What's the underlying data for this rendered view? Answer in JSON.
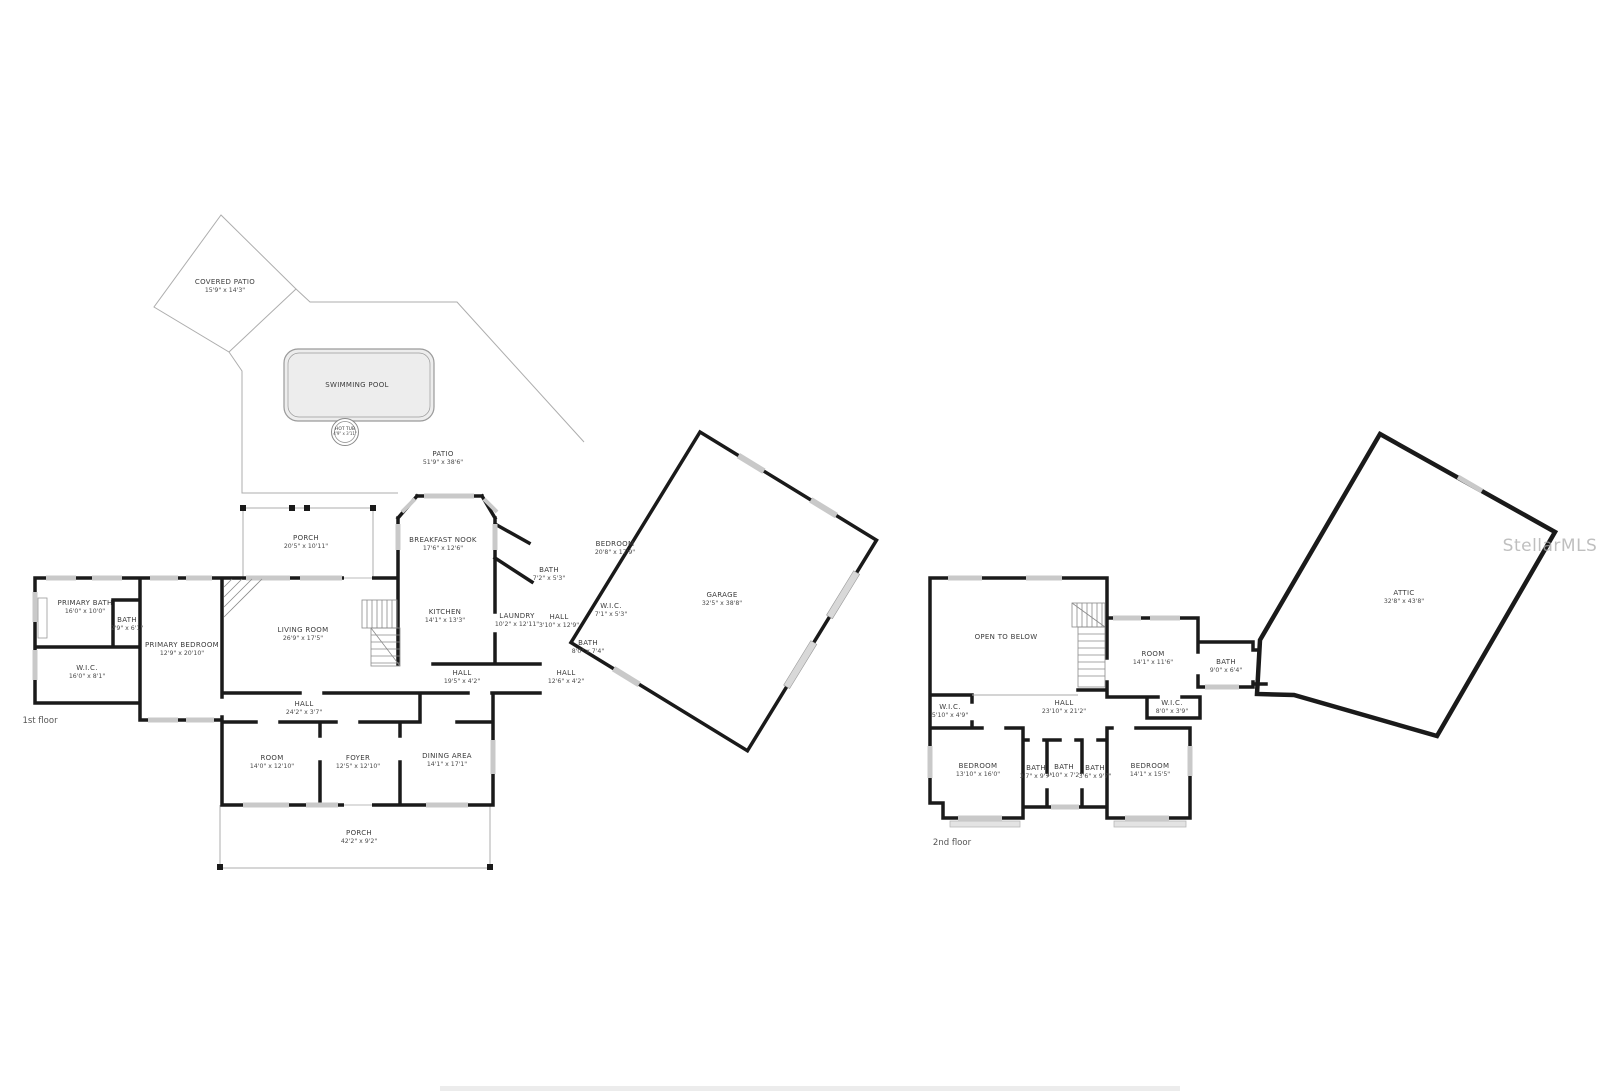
{
  "watermark": "StellarMLS",
  "floors": [
    {
      "caption": "1st floor",
      "caption_x": 40,
      "caption_y": 721,
      "rooms": [
        {
          "name": "COVERED PATIO",
          "dims": "15'9\" x 14'3\"",
          "x": 225,
          "y": 286
        },
        {
          "name": "SWIMMING POOL",
          "dims": "",
          "x": 357,
          "y": 385
        },
        {
          "name": "HOT TUB",
          "dims": "4'9\" x 3'11\"",
          "x": 345,
          "y": 432,
          "cls": "xs"
        },
        {
          "name": "PATIO",
          "dims": "51'9\" x 38'6\"",
          "x": 443,
          "y": 458
        },
        {
          "name": "PORCH",
          "dims": "20'5\" x 10'11\"",
          "x": 306,
          "y": 542
        },
        {
          "name": "BREAKFAST NOOK",
          "dims": "17'6\" x 12'6\"",
          "x": 443,
          "y": 544
        },
        {
          "name": "KITCHEN",
          "dims": "14'1\" x 13'3\"",
          "x": 445,
          "y": 616
        },
        {
          "name": "LAUNDRY",
          "dims": "10'2\" x 12'11\"",
          "x": 517,
          "y": 620
        },
        {
          "name": "BEDROOM",
          "dims": "20'8\" x 17'9\"",
          "x": 615,
          "y": 548
        },
        {
          "name": "BATH",
          "dims": "7'2\" x 5'3\"",
          "x": 549,
          "y": 574
        },
        {
          "name": "W.I.C.",
          "dims": "7'1\" x 5'3\"",
          "x": 611,
          "y": 610
        },
        {
          "name": "HALL",
          "dims": "3'10\" x 12'9\"",
          "x": 559,
          "y": 621
        },
        {
          "name": "BATH",
          "dims": "8'0\" x 7'4\"",
          "x": 588,
          "y": 647
        },
        {
          "name": "GARAGE",
          "dims": "32'5\" x 38'8\"",
          "x": 722,
          "y": 599
        },
        {
          "name": "PRIMARY BATH",
          "dims": "16'0\" x 10'0\"",
          "x": 85,
          "y": 607
        },
        {
          "name": "BATH",
          "dims": "2'9\" x 6'1\"",
          "x": 127,
          "y": 624
        },
        {
          "name": "W.I.C.",
          "dims": "16'0\" x 8'1\"",
          "x": 87,
          "y": 672
        },
        {
          "name": "PRIMARY BEDROOM",
          "dims": "12'9\" x 20'10\"",
          "x": 182,
          "y": 649
        },
        {
          "name": "LIVING ROOM",
          "dims": "26'9\" x 17'5\"",
          "x": 303,
          "y": 634
        },
        {
          "name": "HALL",
          "dims": "24'2\" x 3'7\"",
          "x": 304,
          "y": 708
        },
        {
          "name": "HALL",
          "dims": "19'5\" x 4'2\"",
          "x": 462,
          "y": 677
        },
        {
          "name": "HALL",
          "dims": "12'6\" x 4'2\"",
          "x": 566,
          "y": 677
        },
        {
          "name": "ROOM",
          "dims": "14'0\" x 12'10\"",
          "x": 272,
          "y": 762
        },
        {
          "name": "FOYER",
          "dims": "12'5\" x 12'10\"",
          "x": 358,
          "y": 762
        },
        {
          "name": "DINING AREA",
          "dims": "14'1\" x 17'1\"",
          "x": 447,
          "y": 760
        },
        {
          "name": "PORCH",
          "dims": "42'2\" x 9'2\"",
          "x": 359,
          "y": 837
        }
      ]
    },
    {
      "caption": "2nd floor",
      "caption_x": 952,
      "caption_y": 843,
      "rooms": [
        {
          "name": "OPEN TO BELOW",
          "dims": "",
          "x": 1006,
          "y": 637
        },
        {
          "name": "ROOM",
          "dims": "14'1\" x 11'6\"",
          "x": 1153,
          "y": 658
        },
        {
          "name": "BATH",
          "dims": "9'0\" x 6'4\"",
          "x": 1226,
          "y": 666
        },
        {
          "name": "W.I.C.",
          "dims": "5'10\" x 4'9\"",
          "x": 950,
          "y": 711
        },
        {
          "name": "HALL",
          "dims": "23'10\" x 21'2\"",
          "x": 1064,
          "y": 707
        },
        {
          "name": "W.I.C.",
          "dims": "8'0\" x 3'9\"",
          "x": 1172,
          "y": 707
        },
        {
          "name": "BEDROOM",
          "dims": "13'10\" x 16'0\"",
          "x": 978,
          "y": 770
        },
        {
          "name": "BATH",
          "dims": "3'7\" x 9'7\"",
          "x": 1036,
          "y": 772
        },
        {
          "name": "BATH",
          "dims": "4'10\" x 7'2\"",
          "x": 1064,
          "y": 771
        },
        {
          "name": "BATH",
          "dims": "3'6\" x 9'7\"",
          "x": 1095,
          "y": 772
        },
        {
          "name": "BEDROOM",
          "dims": "14'1\" x 15'5\"",
          "x": 1150,
          "y": 770
        },
        {
          "name": "ATTIC",
          "dims": "32'8\" x 43'8\"",
          "x": 1404,
          "y": 597
        }
      ]
    }
  ]
}
